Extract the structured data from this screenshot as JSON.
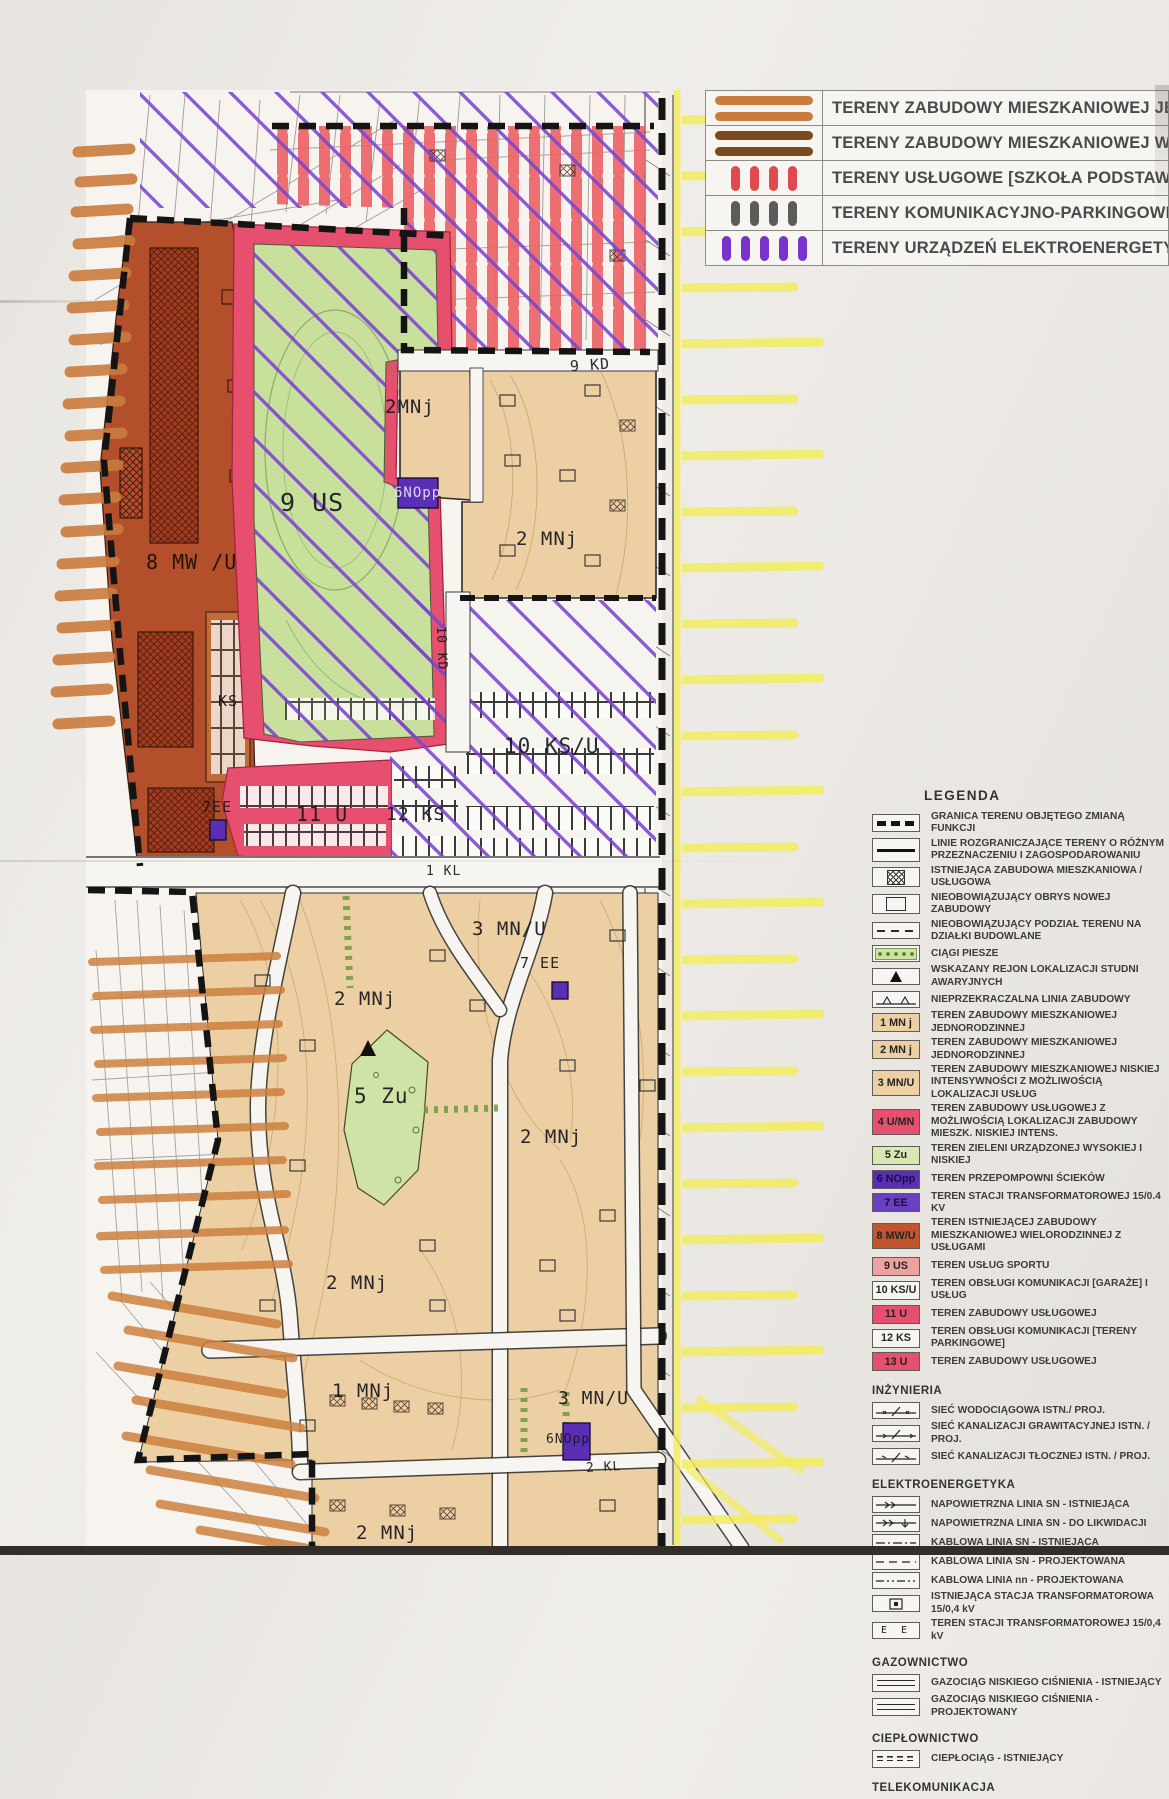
{
  "top_legend": {
    "items": [
      {
        "label": "TERENY ZABUDOWY MIESZKANIOWEJ JED",
        "swatch": "orange-horizontal-strokes"
      },
      {
        "label": "TERENY ZABUDOWY MIESZKANIOWEJ WIE",
        "swatch": "brown-horizontal-strokes"
      },
      {
        "label": "TERENY USŁUGOWE [SZKOŁA PODSTAWO",
        "swatch": "red-vertical-strokes"
      },
      {
        "label": "TERENY KOMUNIKACYJNO-PARKINGOWE",
        "swatch": "gray-vertical-strokes"
      },
      {
        "label": "TERENY URZĄDZEŃ ELEKTROENERGETYC",
        "swatch": "purple-vertical-strokes"
      }
    ]
  },
  "legend": {
    "title": "LEGENDA",
    "symbols": [
      {
        "label": "GRANICA TERENU OBJĘTEGO ZMIANĄ FUNKCJI",
        "icon": "thick-dashed-boundary"
      },
      {
        "label": "LINIE ROZGRANICZAJĄCE TERENY O RÓŻNYM PRZEZNACZENIU I ZAGOSPODAROWANIU",
        "icon": "solid-line"
      },
      {
        "label": "ISTNIEJĄCA ZABUDOWA MIESZKANIOWA / USŁUGOWA",
        "icon": "hatched-building"
      },
      {
        "label": "NIEOBOWIĄZUJĄCY OBRYS NOWEJ ZABUDOWY",
        "icon": "empty-rectangle"
      },
      {
        "label": "NIEOBOWIĄZUJĄCY PODZIAŁ TERENU NA DZIAŁKI BUDOWLANE",
        "icon": "dashed-line"
      },
      {
        "label": "CIĄGI PIESZE",
        "icon": "green-dotted-band"
      },
      {
        "label": "WSKAZANY REJON LOKALIZACJI STUDNI AWARYJNYCH",
        "icon": "black-triangle"
      },
      {
        "label": "NIEPRZEKRACZALNA LINIA ZABUDOWY",
        "icon": "line-with-triangles"
      }
    ],
    "zones": [
      {
        "code": "1 MN j",
        "label": "TEREN ZABUDOWY MIESZKANIOWEJ JEDNORODZINNEJ",
        "color": "#ecd0a4"
      },
      {
        "code": "2 MN j",
        "label": "TEREN ZABUDOWY MIESZKANIOWEJ JEDNORODZINNEJ",
        "color": "#ecd0a4"
      },
      {
        "code": "3 MN/U",
        "label": "TEREN ZABUDOWY MIESZKANIOWEJ NISKIEJ INTENSYWNOŚCI Z MOŻLIWOŚCIĄ LOKALIZACJI USŁUG",
        "color": "#ecd0a4"
      },
      {
        "code": "4 U/MN",
        "label": "TEREN ZABUDOWY USŁUGOWEJ Z MOŻLIWOŚCIĄ LOKALIZACJI ZABUDOWY MIESZK. NISKIEJ INTENS.",
        "color": "#e6506e"
      },
      {
        "code": "5 Zu",
        "label": "TEREN ZIELENI URZĄDZONEJ WYSOKIEJ I NISKIEJ",
        "color": "#d9e7b0"
      },
      {
        "code": "6 NOpp",
        "label": "TEREN PRZEPOMPOWNI ŚCIEKÓW",
        "color": "#5b2fb5"
      },
      {
        "code": "7 EE",
        "label": "TEREN STACJI TRANSFORMATOROWEJ 15/0.4 KV",
        "color": "#6a3fc0"
      },
      {
        "code": "8 MW/U",
        "label": "TEREN ISTNIEJĄCEJ ZABUDOWY MIESZKANIOWEJ WIELORODZINNEJ Z USŁUGAMI",
        "color": "#c2542f"
      },
      {
        "code": "9 US",
        "label": "TEREN USŁUG SPORTU",
        "color": "#eea2a0"
      },
      {
        "code": "10 KS/U",
        "label": "TEREN OBSŁUGI KOMUNIKACJI [GARAŻE] I USŁUG",
        "color": "#f7f5f1"
      },
      {
        "code": "11 U",
        "label": "TEREN ZABUDOWY USŁUGOWEJ",
        "color": "#e6506e"
      },
      {
        "code": "12 KS",
        "label": "TEREN OBSŁUGI KOMUNIKACJI [TERENY PARKINGOWE]",
        "color": "#f7f5f1"
      },
      {
        "code": "13 U",
        "label": "TEREN ZABUDOWY USŁUGOWEJ",
        "color": "#e6506e"
      }
    ],
    "inzynieria": {
      "title": "INŻYNIERIA",
      "items": [
        {
          "label": "SIEĆ WODOCIĄGOWA ISTN./ PROJ."
        },
        {
          "label": "SIEĆ KANALIZACJI GRAWITACYJNEJ ISTN. / PROJ."
        },
        {
          "label": "SIEĆ KANALIZACJI TŁOCZNEJ ISTN. / PROJ."
        }
      ]
    },
    "elektroenergetyka": {
      "title": "ELEKTROENERGETYKA",
      "items": [
        {
          "label": "NAPOWIETRZNA LINIA SN - ISTNIEJĄCA"
        },
        {
          "label": "NAPOWIETRZNA LINIA SN - DO LIKWIDACJI"
        },
        {
          "label": "KABLOWA LINIA SN - ISTNIEJĄCA"
        },
        {
          "label": "KABLOWA LINIA SN - PROJEKTOWANA"
        },
        {
          "label": "KABLOWA LINIA nn - PROJEKTOWANA"
        },
        {
          "label": "ISTNIEJĄCA STACJA TRANSFORMATOROWA 15/0,4 kV"
        },
        {
          "label": "TEREN STACJI TRANSFORMATOROWEJ 15/0,4 kV",
          "symbol_text": "E E"
        }
      ]
    },
    "gazownictwo": {
      "title": "GAZOWNICTWO",
      "items": [
        {
          "label": "GAZOCIĄG NISKIEGO CIŚNIENIA - ISTNIEJĄCY"
        },
        {
          "label": "GAZOCIĄG NISKIEGO CIŚNIENIA - PROJEKTOWANY"
        }
      ]
    },
    "cieplownictwo": {
      "title": "CIEPŁOWNICTWO",
      "items": [
        {
          "label": "CIEPŁOCIĄG - ISTNIEJĄCY"
        }
      ]
    },
    "telekomunikacja": {
      "title": "TELEKOMUNIKACJA"
    }
  },
  "map": {
    "labels": [
      {
        "text": "2MNj"
      },
      {
        "text": "9 KD"
      },
      {
        "text": "2 MNj"
      },
      {
        "text": "6NOpp"
      },
      {
        "text": "9 US"
      },
      {
        "text": "8 MW /U"
      },
      {
        "text": "KS"
      },
      {
        "text": "10 KD"
      },
      {
        "text": "10 KS/U"
      },
      {
        "text": "7EE"
      },
      {
        "text": "11 U"
      },
      {
        "text": "12 KS"
      },
      {
        "text": "1 KL"
      },
      {
        "text": "3 MN/U"
      },
      {
        "text": "7 EE"
      },
      {
        "text": "2 MNj"
      },
      {
        "text": "5 Zu"
      },
      {
        "text": "2 MNj"
      },
      {
        "text": "2 MNj"
      },
      {
        "text": "1 MNj"
      },
      {
        "text": "3 MN/U"
      },
      {
        "text": "6NOpp"
      },
      {
        "text": "2 KL"
      },
      {
        "text": "2 MNj"
      }
    ],
    "colors": {
      "single_family_tan": "#ecd0a4",
      "services_pink": "#e6506e",
      "green_areas": "#c8e09c",
      "multifamily_dark_red": "#b44f2c",
      "electro_purple": "#5b2fb5",
      "school_red_stripes": "#ee6466",
      "hatch_purple": "#7b45c8",
      "highlighter_yellow": "#f3ec60",
      "highlighter_orange": "#c97c3e",
      "highlighter_brown": "#7c4a1e",
      "boundary_black": "#141414"
    }
  }
}
